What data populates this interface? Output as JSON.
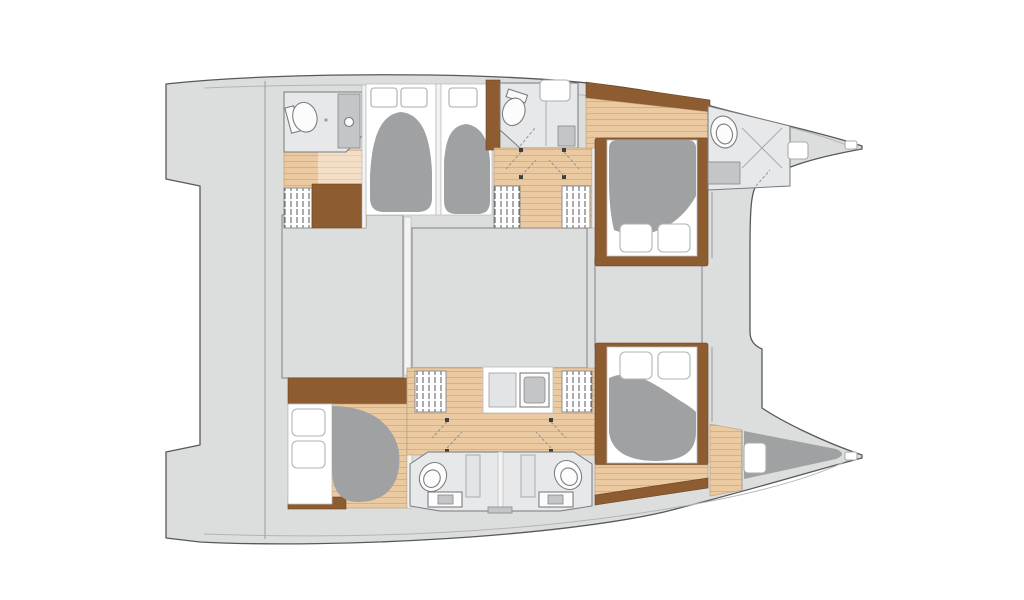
{
  "diagram": {
    "type": "catamaran-yacht-floor-plan",
    "orientation": "bow-right",
    "hulls": [
      {
        "name": "upper-hull",
        "rooms": [
          {
            "name": "aft-bathroom",
            "fixtures": [
              "toilet",
              "shower",
              "sink-cabinet"
            ]
          },
          {
            "name": "aft-cabin-1",
            "furniture": [
              "double-bed",
              "wardrobe",
              "dresser"
            ]
          },
          {
            "name": "aft-cabin-2",
            "furniture": [
              "double-bed"
            ]
          },
          {
            "name": "mid-bathroom",
            "fixtures": [
              "toilet",
              "shower",
              "sink"
            ]
          },
          {
            "name": "forward-cabin",
            "furniture": [
              "double-bed",
              "wardrobe",
              "wardrobe"
            ]
          },
          {
            "name": "bow-bathroom",
            "fixtures": [
              "toilet",
              "shower",
              "sink-cabinet"
            ]
          }
        ]
      },
      {
        "name": "lower-hull",
        "rooms": [
          {
            "name": "aft-cabin",
            "furniture": [
              "double-bed",
              "wardrobe"
            ]
          },
          {
            "name": "twin-bathrooms",
            "fixtures": [
              "toilet",
              "sink",
              "shower",
              "toilet",
              "sink",
              "shower"
            ]
          },
          {
            "name": "galley-vanity-unit",
            "fixtures": [
              "counter",
              "sink"
            ]
          },
          {
            "name": "forward-cabin",
            "furniture": [
              "double-bed",
              "wardrobe"
            ]
          },
          {
            "name": "bow-forepeak",
            "furniture": [
              "berth",
              "deck-hatch"
            ]
          }
        ]
      }
    ],
    "bridgedeck": {
      "blocks": 3,
      "description": "central saloon and cockpit masses"
    },
    "counts": {
      "double_beds": 5,
      "bathrooms": 5,
      "wardrobes": 5,
      "deck_hatches": 6,
      "pillows": 6
    }
  },
  "colors": {
    "background": "#ffffff",
    "deck": "#dcdddd",
    "outline": "#56585c",
    "innerline": "#b3b5b7",
    "blockstroke": "#9a9c9e",
    "bathfloor": "#e7e8e9",
    "roomstroke": "#77797c",
    "furniture": "#8d5c31",
    "furnedge": "#6f4523",
    "duvet": "#9fa1a3",
    "wood": "#ebc9a1",
    "wood_plank": "#dcb07e",
    "wood_light": "#f4dfc6",
    "wood_light_plank": "#e8cda9",
    "fixture": "#c3c5c7",
    "woodedge": "#b99c74"
  }
}
